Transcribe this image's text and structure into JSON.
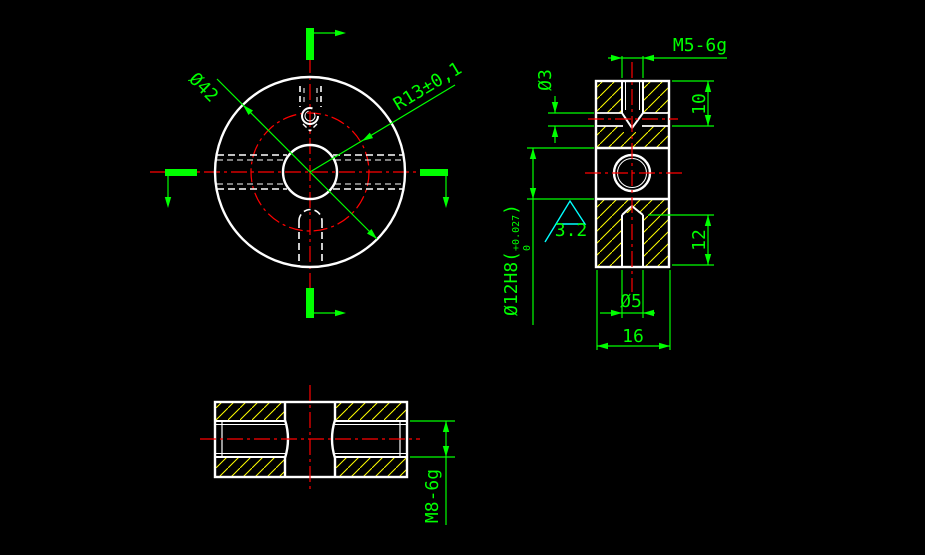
{
  "colors": {
    "background": "#000000",
    "outline": "#ffffff",
    "dimension": "#00ff00",
    "centerline": "#ff0000",
    "hatch": "#ffff00",
    "roughness_symbol": "#00ffff"
  },
  "front_view": {
    "dia_label": "Ø42",
    "radius_label": "R13±0,1"
  },
  "side_view": {
    "thread_label": "M5-6g",
    "cross_hole_label": "Ø3",
    "thread_depth_label": "10",
    "bore_label_main": "Ø12H8(",
    "bore_tol_upper": "+0.027",
    "bore_tol_lower": "0",
    "bore_label_close": ")",
    "roughness_value": "3.2",
    "slot_depth_label": "12",
    "slot_dia_label": "Ø5",
    "width_label": "16"
  },
  "bottom_view": {
    "thread_label": "M8-6g"
  }
}
